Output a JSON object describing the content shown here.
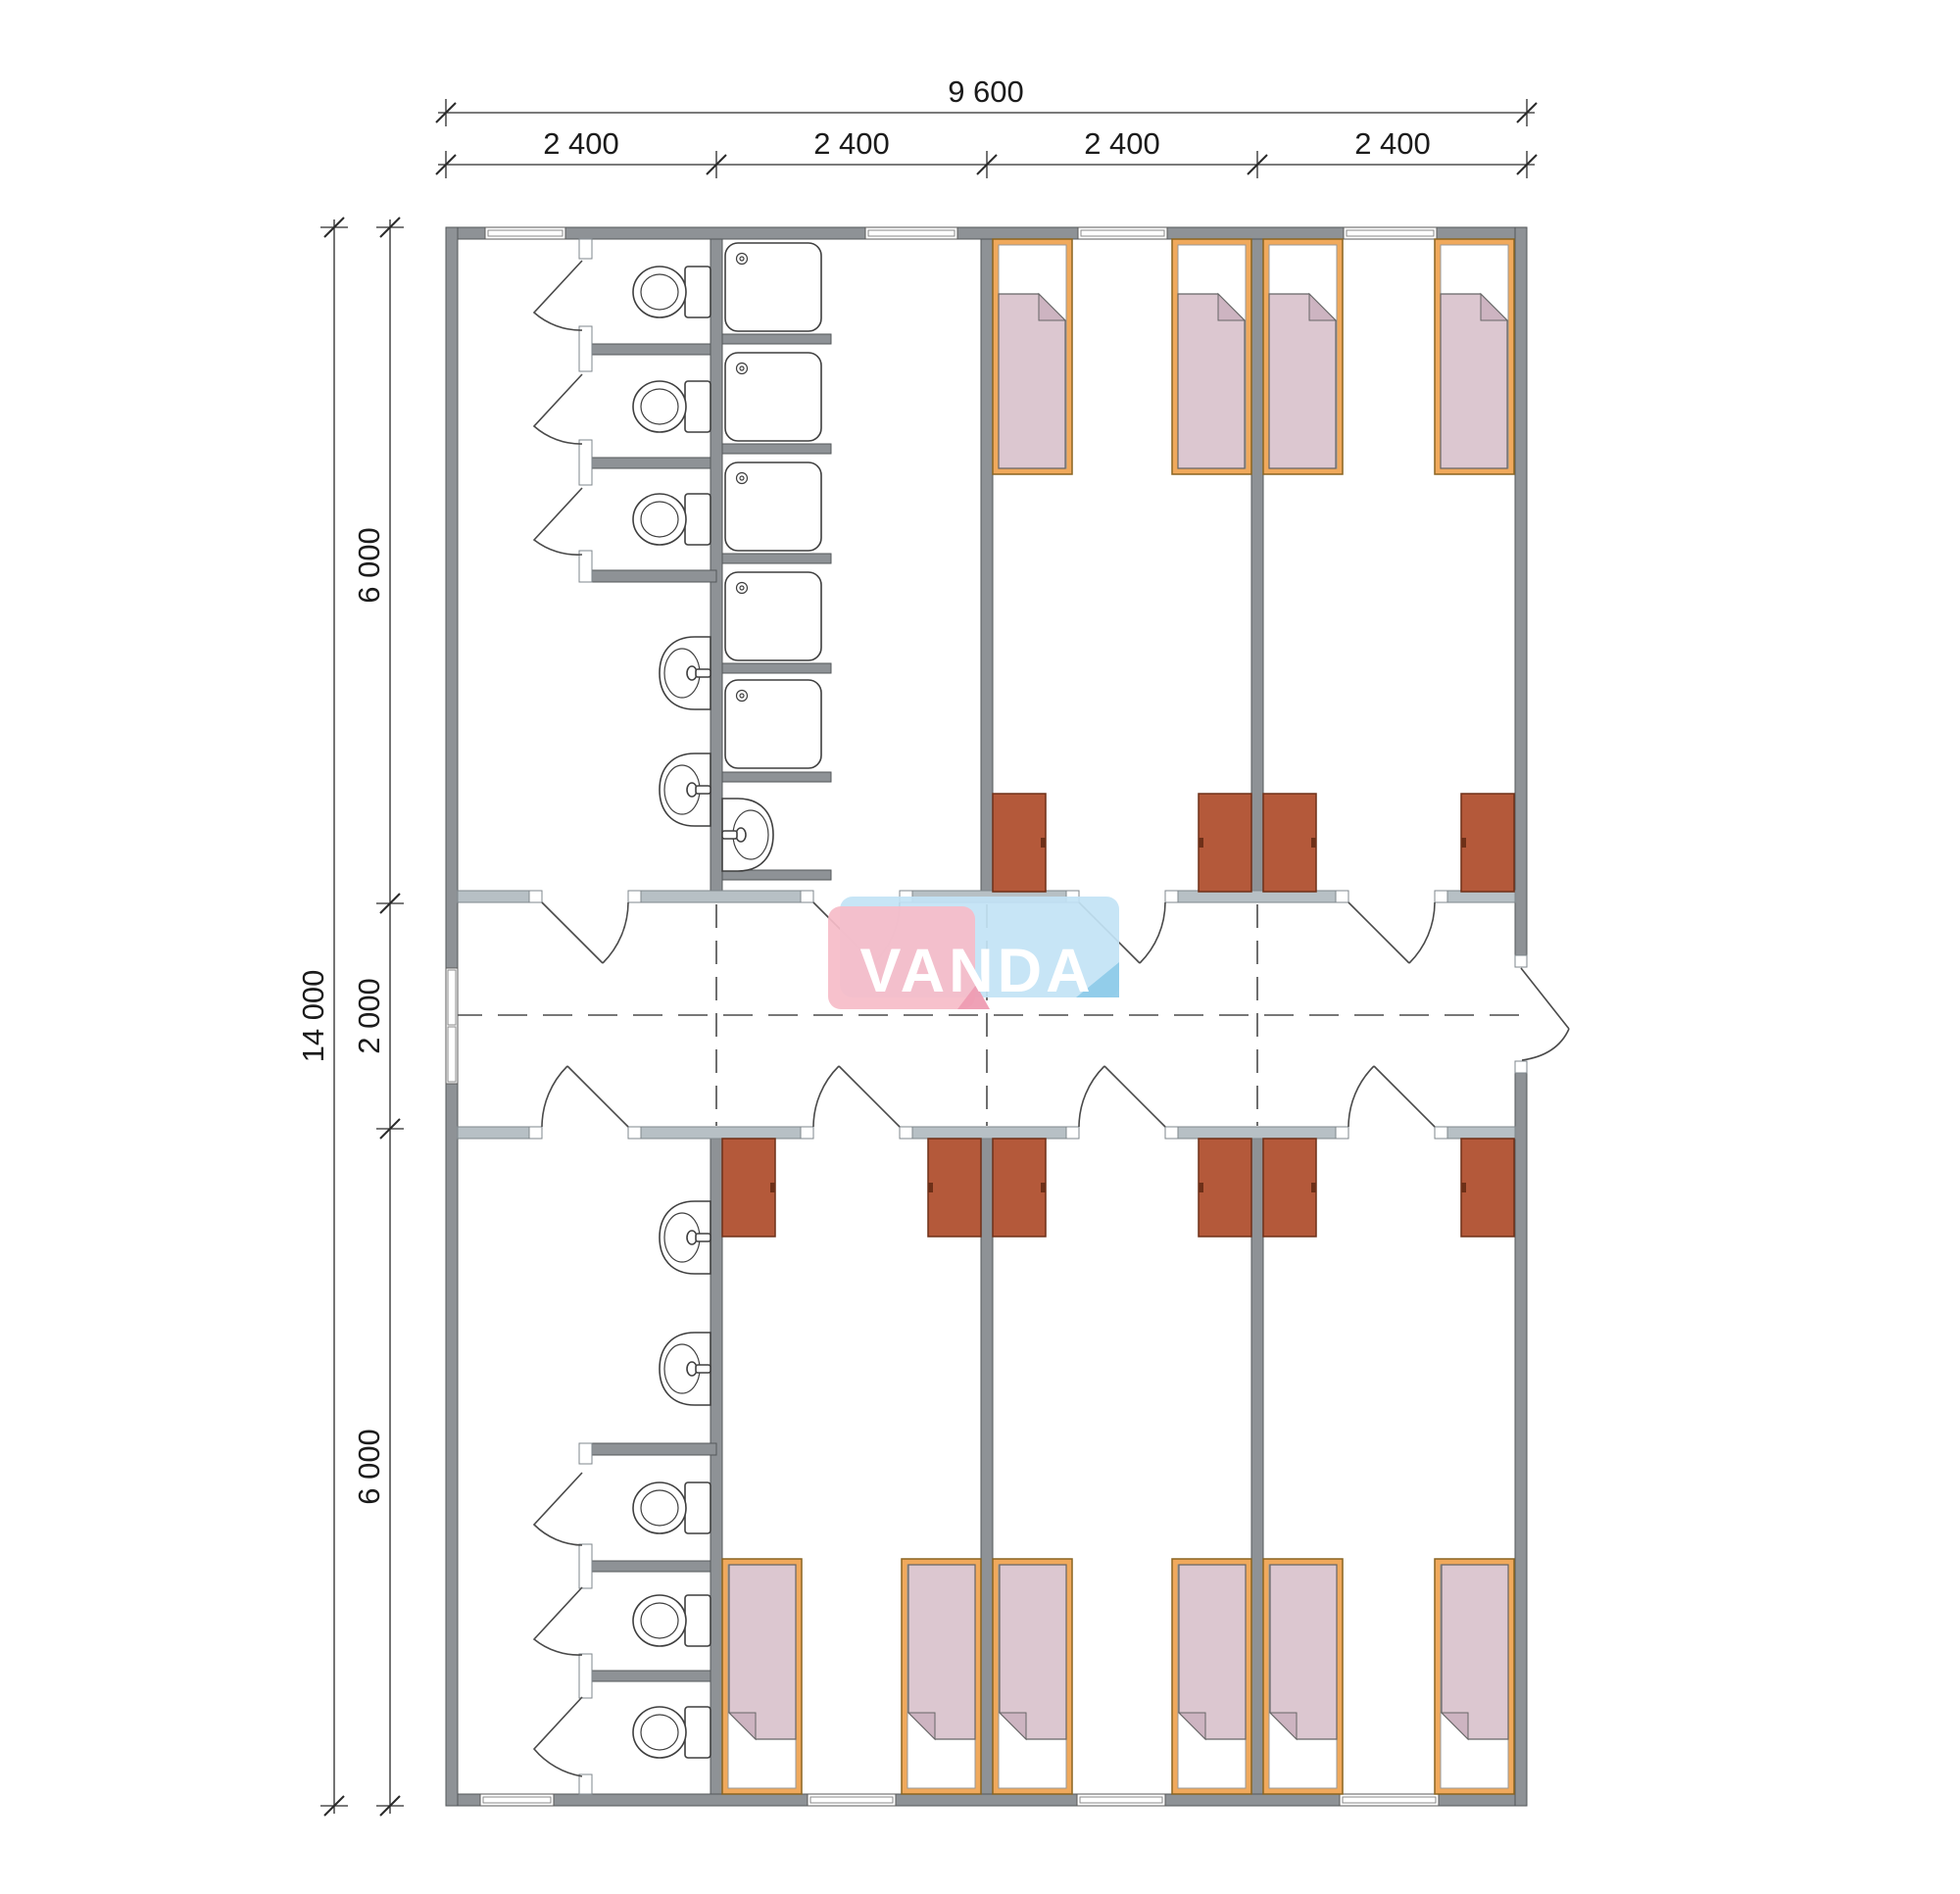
{
  "document": {
    "type": "architectural floor plan",
    "units": "mm"
  },
  "logo": {
    "text": "VANDA"
  },
  "dimensions": {
    "top_total": "9 600",
    "top_segments": [
      "2 400",
      "2 400",
      "2 400",
      "2 400"
    ],
    "left_total": "14 000",
    "left_segments": [
      "6 000",
      "2 000",
      "6 000"
    ]
  },
  "fixtures": {
    "beds": 10,
    "wardrobes": 10,
    "toilets": 6,
    "shower_trays": 5,
    "washbasins": 5,
    "windows": 8,
    "room_doors": 8,
    "stall_doors": 6,
    "exterior_doors": 2
  },
  "colors": {
    "paper": "#ffffff",
    "wall": "#8e9296",
    "wallStroke": "#54585b",
    "corridorWall": "#b7c0c5",
    "corridorWallStroke": "#7f878c",
    "line": "#4a4a4a",
    "dim": "#2a2a2a",
    "fixtureStroke": "#3f3f3f",
    "bedFrame": "#f0a95c",
    "bedFrameStroke": "#8a6420",
    "blanket": "#dcc7d0",
    "blanketFold": "#cdb4c1",
    "blanketStroke": "#666666",
    "wardrobe": "#b4593a",
    "wardrobeStroke": "#6e3018",
    "logoPink": "#f6bcc8",
    "logoPinkFold": "#ee9cb2",
    "logoBlue": "#c2e3f5",
    "logoBlueFold": "#8fcbe9",
    "logoText": "#ffffff"
  }
}
